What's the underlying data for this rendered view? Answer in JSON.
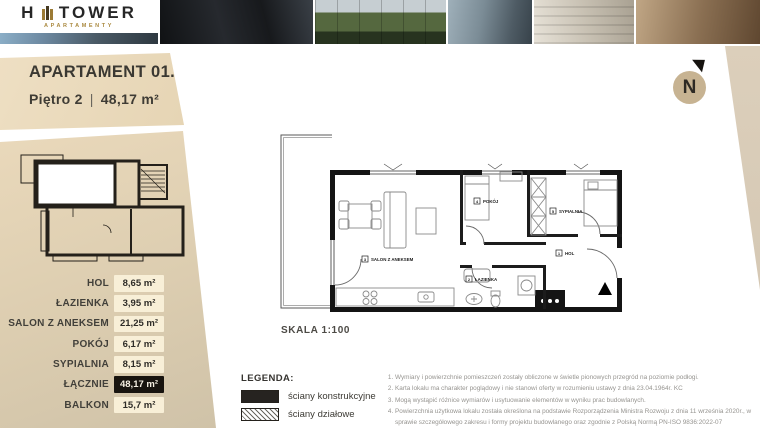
{
  "brand": {
    "logo_left": "H",
    "logo_right": "TOWER",
    "subtitle": "APARTAMENTY"
  },
  "header": {
    "title": "APARTAMENT 01.2",
    "floor": "Piętro 2",
    "divider": "|",
    "area": "48,17 m²"
  },
  "compass": {
    "label": "N"
  },
  "sidebar": {
    "rows": [
      {
        "label": "HOL",
        "value": "8,65 m²"
      },
      {
        "label": "ŁAZIENKA",
        "value": "3,95 m²"
      },
      {
        "label": "SALON Z ANEKSEM",
        "value": "21,25 m²"
      },
      {
        "label": "POKÓJ",
        "value": "6,17 m²"
      },
      {
        "label": "SYPIALNIA",
        "value": "8,15 m²"
      },
      {
        "label": "ŁĄCZNIE",
        "value": "48,17 m²"
      },
      {
        "label": "BALKON",
        "value": "15,7 m²"
      }
    ]
  },
  "plan": {
    "scale": "SKALA 1:100",
    "rooms": [
      {
        "num": "1",
        "name": "HOL"
      },
      {
        "num": "2",
        "name": "ŁAZIENKA"
      },
      {
        "num": "3",
        "name": "SALON Z ANEKSEM"
      },
      {
        "num": "4",
        "name": "POKÓJ"
      },
      {
        "num": "5",
        "name": "SYPIALNIA"
      }
    ]
  },
  "legend": {
    "title": "LEGENDA:",
    "items": [
      {
        "label": "ściany konstrukcyjne"
      },
      {
        "label": "ściany działowe"
      }
    ]
  },
  "notes": {
    "items": [
      "Wymiary i powierzchnie pomieszczeń zostały obliczone w świetle pionowych przegród na poziomie podłogi.",
      "Karta lokalu ma charakter poglądowy i nie stanowi oferty w rozumieniu ustawy z dnia 23.04.1964r. KC",
      "Mogą wystąpić różnice wymiarów i usytuowanie elementów w wyniku prac budowlanych.",
      "Powierzchnia użytkowa lokalu została określona na podstawie Rozporządzenia Ministra Rozwoju z dnia 11 września 2020r., w sprawie szczegółowego zakresu i formy projektu budowlanego oraz zgodnie z Polską Normą PN-ISO 9836:2022-07"
    ]
  },
  "colors": {
    "banner": "#e9d9bb",
    "sidebar_top": "#ead9bb",
    "sidebar_bottom": "#cfc2a8",
    "value_box": "#f8efd7",
    "total_box": "#18140f",
    "gold": "#ab8a41",
    "band": "#dacdb9"
  }
}
